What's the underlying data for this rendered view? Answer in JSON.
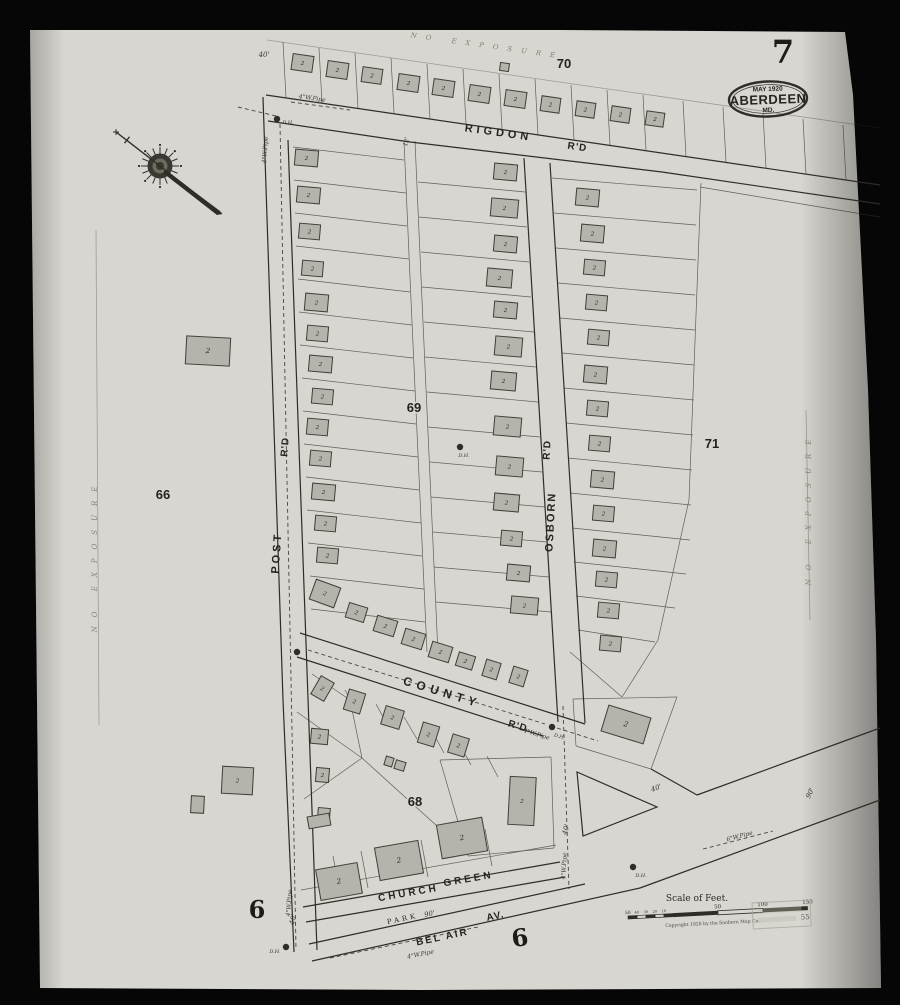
{
  "sheet": {
    "number": "7",
    "badge": {
      "line1": "MAY 1920",
      "city": "ABERDEEN",
      "state": "MD."
    }
  },
  "legend": {
    "scale_title": "Scale of Feet.",
    "copyright": "Copyright 1920 by the Sanborn Map Co.",
    "bar_ticks_small": [
      "50",
      "40",
      "30",
      "20",
      "10"
    ],
    "bar_ticks_big": [
      "50",
      "100",
      "150"
    ],
    "stamp_text": "55"
  },
  "colors": {
    "bg": "#060606",
    "paper": "#d8d6d0",
    "ink": "#2e2d27",
    "building_fill": "#b5b3ac",
    "building_stroke": "#403e37",
    "faint": "#8a877c"
  },
  "labels": [
    {
      "t": "RIGDON",
      "x": 498,
      "y": 136,
      "r": 8,
      "s": 11,
      "cls": "street",
      "ls": 4
    },
    {
      "t": "R'D",
      "x": 577,
      "y": 150,
      "r": 8,
      "s": 10,
      "cls": "street",
      "ls": 1
    },
    {
      "t": "POST",
      "x": 280,
      "y": 553,
      "r": -86,
      "s": 11,
      "cls": "street",
      "ls": 3
    },
    {
      "t": "R'D",
      "x": 288,
      "y": 447,
      "r": -86,
      "s": 10,
      "cls": "street",
      "ls": 1
    },
    {
      "t": "OSBORN",
      "x": 554,
      "y": 522,
      "r": -87,
      "s": 11,
      "cls": "street",
      "ls": 2
    },
    {
      "t": "R'D",
      "x": 550,
      "y": 450,
      "r": -87,
      "s": 10,
      "cls": "street",
      "ls": 1
    },
    {
      "t": "COUNTY",
      "x": 441,
      "y": 696,
      "r": 17,
      "s": 12,
      "cls": "street",
      "ls": 5
    },
    {
      "t": "R'D",
      "x": 517,
      "y": 729,
      "r": 17,
      "s": 10,
      "cls": "street",
      "ls": 1
    },
    {
      "t": "CHURCH",
      "x": 409,
      "y": 896,
      "r": -10,
      "s": 10,
      "cls": "street",
      "ls": 3
    },
    {
      "t": "GREEN",
      "x": 469,
      "y": 882,
      "r": -10,
      "s": 10,
      "cls": "street",
      "ls": 3
    },
    {
      "t": "PARK",
      "x": 403,
      "y": 921,
      "r": -12,
      "s": 7,
      "cls": "serif",
      "ls": 3
    },
    {
      "t": "BEL AIR",
      "x": 443,
      "y": 940,
      "r": -12,
      "s": 10,
      "cls": "street",
      "ls": 2
    },
    {
      "t": "AV.",
      "x": 496,
      "y": 919,
      "r": -12,
      "s": 10,
      "cls": "street",
      "ls": 1
    },
    {
      "t": "70",
      "x": 564,
      "y": 68,
      "r": 0,
      "s": 13,
      "cls": "block"
    },
    {
      "t": "69",
      "x": 414,
      "y": 412,
      "r": 0,
      "s": 13,
      "cls": "block"
    },
    {
      "t": "71",
      "x": 712,
      "y": 448,
      "r": 0,
      "s": 13,
      "cls": "block"
    },
    {
      "t": "66",
      "x": 163,
      "y": 499,
      "r": 0,
      "s": 13,
      "cls": "block"
    },
    {
      "t": "68",
      "x": 415,
      "y": 806,
      "r": 0,
      "s": 13,
      "cls": "block"
    },
    {
      "t": "6",
      "x": 257,
      "y": 918,
      "r": 0,
      "s": 24,
      "cls": "ref"
    },
    {
      "t": "6",
      "x": 521,
      "y": 946,
      "r": -8,
      "s": 24,
      "cls": "ref"
    },
    {
      "t": "7",
      "x": 783,
      "y": 63,
      "r": 0,
      "s": 32,
      "cls": "ref"
    },
    {
      "t": "NO EXPOSURE",
      "x": 487,
      "y": 48,
      "r": 8,
      "s": 7,
      "cls": "exposure",
      "ls": 9
    },
    {
      "t": "NO EXPOSURE",
      "x": 97,
      "y": 555,
      "r": -90,
      "s": 7,
      "cls": "exposure",
      "ls": 9
    },
    {
      "t": "NO EXPOSURE",
      "x": 811,
      "y": 508,
      "r": -90,
      "s": 7,
      "cls": "exposure",
      "ls": 9
    },
    {
      "t": "4\"W.Pipe",
      "x": 312,
      "y": 100,
      "r": 8,
      "s": 6,
      "cls": "tiny"
    },
    {
      "t": "4\"W.Pipe",
      "x": 267,
      "y": 150,
      "r": -86,
      "s": 6,
      "cls": "tiny"
    },
    {
      "t": "4\"W.Pipe",
      "x": 291,
      "y": 903,
      "r": -86,
      "s": 6,
      "cls": "tiny"
    },
    {
      "t": "4\"W.Pipe",
      "x": 536,
      "y": 736,
      "r": 17,
      "s": 6,
      "cls": "tiny"
    },
    {
      "t": "4\"W.Pipe",
      "x": 566,
      "y": 866,
      "r": -87,
      "s": 6,
      "cls": "tiny"
    },
    {
      "t": "4\"W.Pipe",
      "x": 421,
      "y": 956,
      "r": -12,
      "s": 6,
      "cls": "tiny"
    },
    {
      "t": "6\"W.Pipe",
      "x": 740,
      "y": 838,
      "r": -15,
      "s": 6,
      "cls": "tiny"
    },
    {
      "t": "40'",
      "x": 264,
      "y": 57,
      "r": 0,
      "s": 7,
      "cls": "tiny"
    },
    {
      "t": "40'",
      "x": 568,
      "y": 830,
      "r": -75,
      "s": 7,
      "cls": "tiny"
    },
    {
      "t": "40'",
      "x": 657,
      "y": 790,
      "r": -20,
      "s": 7,
      "cls": "tiny"
    },
    {
      "t": "40'",
      "x": 295,
      "y": 920,
      "r": -75,
      "s": 7,
      "cls": "tiny"
    },
    {
      "t": "90'",
      "x": 812,
      "y": 794,
      "r": -65,
      "s": 7,
      "cls": "tiny"
    },
    {
      "t": "90'",
      "x": 430,
      "y": 916,
      "r": -12,
      "s": 7,
      "cls": "tiny"
    },
    {
      "t": "12'",
      "x": 408,
      "y": 142,
      "r": -78,
      "s": 6,
      "cls": "tiny"
    },
    {
      "t": "D.H.",
      "x": 288,
      "y": 124,
      "r": 0,
      "s": 5,
      "cls": "tiny"
    },
    {
      "t": "D.H.",
      "x": 559,
      "y": 738,
      "r": 17,
      "s": 5,
      "cls": "tiny"
    },
    {
      "t": "D.H.",
      "x": 641,
      "y": 877,
      "r": 0,
      "s": 5,
      "cls": "tiny"
    },
    {
      "t": "D.H.",
      "x": 275,
      "y": 953,
      "r": 0,
      "s": 5,
      "cls": "tiny"
    },
    {
      "t": "D.H.",
      "x": 464,
      "y": 457,
      "r": 0,
      "s": 5,
      "cls": "tiny"
    }
  ],
  "buildings": [
    [
      292,
      55,
      21,
      16,
      8,
      "2"
    ],
    [
      327,
      62,
      21,
      16,
      8,
      "2"
    ],
    [
      362,
      68,
      20,
      15,
      8,
      "2"
    ],
    [
      398,
      75,
      21,
      16,
      8,
      "2"
    ],
    [
      433,
      80,
      21,
      16,
      8,
      "2"
    ],
    [
      469,
      86,
      21,
      16,
      8,
      "2"
    ],
    [
      505,
      91,
      21,
      16,
      8,
      "2"
    ],
    [
      541,
      97,
      19,
      15,
      8,
      "2"
    ],
    [
      576,
      102,
      19,
      15,
      8,
      "2"
    ],
    [
      611,
      107,
      19,
      15,
      8,
      "2"
    ],
    [
      646,
      112,
      18,
      14,
      8,
      "2"
    ],
    [
      500,
      63,
      9,
      8,
      8,
      ""
    ],
    [
      295,
      150,
      23,
      16,
      5,
      "2"
    ],
    [
      297,
      187,
      23,
      16,
      5,
      "2"
    ],
    [
      299,
      224,
      21,
      15,
      5,
      "2"
    ],
    [
      302,
      261,
      21,
      15,
      5,
      "2"
    ],
    [
      305,
      294,
      23,
      17,
      5,
      "2"
    ],
    [
      307,
      326,
      21,
      15,
      5,
      "2"
    ],
    [
      309,
      356,
      23,
      16,
      5,
      "2"
    ],
    [
      312,
      389,
      21,
      15,
      5,
      "2"
    ],
    [
      307,
      419,
      21,
      16,
      5,
      "2"
    ],
    [
      310,
      451,
      21,
      15,
      5,
      "2"
    ],
    [
      312,
      484,
      23,
      16,
      5,
      "2"
    ],
    [
      315,
      516,
      21,
      15,
      5,
      "2"
    ],
    [
      317,
      548,
      21,
      15,
      5,
      "2"
    ],
    [
      312,
      583,
      26,
      21,
      20,
      "2"
    ],
    [
      347,
      605,
      19,
      15,
      17,
      "2"
    ],
    [
      375,
      618,
      21,
      16,
      17,
      "2"
    ],
    [
      403,
      631,
      21,
      16,
      17,
      "2"
    ],
    [
      430,
      644,
      21,
      16,
      17,
      "2"
    ],
    [
      457,
      654,
      17,
      14,
      17,
      "2"
    ],
    [
      484,
      661,
      15,
      17,
      17,
      "2"
    ],
    [
      511,
      668,
      15,
      17,
      17,
      "2"
    ],
    [
      494,
      164,
      23,
      16,
      5,
      "2"
    ],
    [
      491,
      199,
      27,
      18,
      5,
      "2"
    ],
    [
      494,
      236,
      23,
      16,
      5,
      "2"
    ],
    [
      487,
      269,
      25,
      18,
      5,
      "2"
    ],
    [
      494,
      302,
      23,
      16,
      5,
      "2"
    ],
    [
      495,
      337,
      27,
      19,
      5,
      "2"
    ],
    [
      491,
      372,
      25,
      18,
      5,
      "2"
    ],
    [
      494,
      417,
      27,
      19,
      5,
      "2"
    ],
    [
      496,
      457,
      27,
      19,
      5,
      "2"
    ],
    [
      494,
      494,
      25,
      17,
      5,
      "2"
    ],
    [
      501,
      531,
      21,
      15,
      5,
      "2"
    ],
    [
      507,
      565,
      23,
      16,
      5,
      "2"
    ],
    [
      511,
      597,
      27,
      17,
      5,
      "2"
    ],
    [
      576,
      189,
      23,
      17,
      5,
      "2"
    ],
    [
      581,
      225,
      23,
      17,
      5,
      "2"
    ],
    [
      584,
      260,
      21,
      15,
      5,
      "2"
    ],
    [
      586,
      295,
      21,
      15,
      5,
      "2"
    ],
    [
      588,
      330,
      21,
      15,
      5,
      "2"
    ],
    [
      584,
      366,
      23,
      17,
      5,
      "2"
    ],
    [
      587,
      401,
      21,
      15,
      5,
      "2"
    ],
    [
      589,
      436,
      21,
      15,
      5,
      "2"
    ],
    [
      591,
      471,
      23,
      17,
      5,
      "2"
    ],
    [
      593,
      506,
      21,
      15,
      5,
      "2"
    ],
    [
      593,
      540,
      23,
      17,
      5,
      "2"
    ],
    [
      596,
      572,
      21,
      15,
      5,
      "2"
    ],
    [
      598,
      603,
      21,
      15,
      5,
      "2"
    ],
    [
      600,
      636,
      21,
      15,
      5,
      "2"
    ],
    [
      186,
      337,
      44,
      28,
      3,
      "2"
    ],
    [
      222,
      767,
      31,
      27,
      3,
      "2"
    ],
    [
      191,
      796,
      13,
      17,
      3,
      ""
    ],
    [
      315,
      678,
      15,
      21,
      30,
      "2"
    ],
    [
      346,
      691,
      17,
      21,
      17,
      "2"
    ],
    [
      383,
      708,
      19,
      19,
      17,
      "2"
    ],
    [
      420,
      724,
      17,
      21,
      17,
      "2"
    ],
    [
      450,
      736,
      17,
      19,
      17,
      "2"
    ],
    [
      311,
      729,
      17,
      15,
      5,
      "2"
    ],
    [
      316,
      768,
      13,
      14,
      5,
      "2"
    ],
    [
      385,
      757,
      8,
      9,
      17,
      ""
    ],
    [
      395,
      761,
      10,
      9,
      17,
      ""
    ],
    [
      318,
      808,
      12,
      9,
      5,
      ""
    ],
    [
      509,
      777,
      26,
      48,
      3,
      "2"
    ],
    [
      604,
      711,
      44,
      27,
      17,
      "2"
    ],
    [
      318,
      866,
      42,
      31,
      -10,
      "2"
    ],
    [
      377,
      844,
      44,
      33,
      -10,
      "2"
    ],
    [
      439,
      821,
      46,
      34,
      -10,
      "2"
    ],
    [
      308,
      815,
      22,
      12,
      -10,
      ""
    ]
  ],
  "roads": [
    [
      266,
      95,
      880,
      185
    ],
    [
      268,
      121,
      410,
      142
    ],
    [
      410,
      142,
      662,
      172
    ],
    [
      662,
      172,
      880,
      204
    ],
    [
      263,
      97,
      283,
      700
    ],
    [
      283,
      700,
      294,
      952
    ],
    [
      288,
      140,
      317,
      950
    ],
    [
      524,
      158,
      558,
      722
    ],
    [
      550,
      163,
      585,
      723
    ],
    [
      300,
      633,
      585,
      724
    ],
    [
      297,
      657,
      543,
      736
    ],
    [
      651,
      769,
      697,
      795
    ],
    [
      697,
      795,
      880,
      728
    ],
    [
      640,
      888,
      880,
      800
    ],
    [
      312,
      961,
      640,
      888
    ],
    [
      309,
      944,
      585,
      884
    ],
    [
      303,
      907,
      560,
      862
    ],
    [
      306,
      922,
      565,
      877
    ]
  ],
  "lot_lines": [
    [
      283,
      42,
      286,
      98
    ],
    [
      319,
      48,
      322,
      103
    ],
    [
      355,
      53,
      358,
      108
    ],
    [
      391,
      58,
      394,
      113
    ],
    [
      427,
      64,
      430,
      119
    ],
    [
      463,
      69,
      466,
      124
    ],
    [
      499,
      74,
      502,
      129
    ],
    [
      535,
      79,
      538,
      135
    ],
    [
      571,
      85,
      574,
      140
    ],
    [
      607,
      90,
      610,
      145
    ],
    [
      643,
      95,
      646,
      150
    ],
    [
      683,
      101,
      686,
      156
    ],
    [
      723,
      107,
      726,
      162
    ],
    [
      763,
      113,
      766,
      168
    ],
    [
      803,
      119,
      806,
      174
    ],
    [
      843,
      125,
      846,
      180
    ],
    [
      293,
      147,
      404,
      160
    ],
    [
      294,
      180,
      406,
      193
    ],
    [
      295,
      213,
      407,
      226
    ],
    [
      296,
      246,
      409,
      259
    ],
    [
      298,
      279,
      410,
      292
    ],
    [
      299,
      312,
      412,
      325
    ],
    [
      300,
      345,
      413,
      358
    ],
    [
      302,
      378,
      415,
      391
    ],
    [
      303,
      411,
      416,
      424
    ],
    [
      304,
      444,
      418,
      457
    ],
    [
      306,
      477,
      419,
      490
    ],
    [
      307,
      510,
      421,
      523
    ],
    [
      308,
      543,
      422,
      556
    ],
    [
      310,
      576,
      424,
      589
    ],
    [
      311,
      609,
      425,
      622
    ],
    [
      404,
      141,
      411,
      300
    ],
    [
      411,
      300,
      427,
      652
    ],
    [
      415,
      141,
      422,
      300
    ],
    [
      422,
      300,
      438,
      654
    ],
    [
      418,
      182,
      525,
      192
    ],
    [
      419,
      217,
      527,
      227
    ],
    [
      421,
      252,
      529,
      262
    ],
    [
      422,
      287,
      531,
      297
    ],
    [
      424,
      322,
      534,
      332
    ],
    [
      425,
      357,
      536,
      367
    ],
    [
      427,
      392,
      538,
      402
    ],
    [
      428,
      427,
      540,
      437
    ],
    [
      430,
      462,
      542,
      472
    ],
    [
      431,
      497,
      545,
      507
    ],
    [
      433,
      532,
      547,
      542
    ],
    [
      434,
      567,
      549,
      577
    ],
    [
      436,
      602,
      551,
      612
    ],
    [
      552,
      178,
      697,
      190
    ],
    [
      554,
      213,
      696,
      225
    ],
    [
      556,
      248,
      696,
      260
    ],
    [
      558,
      283,
      695,
      295
    ],
    [
      560,
      318,
      695,
      330
    ],
    [
      562,
      353,
      694,
      365
    ],
    [
      564,
      388,
      694,
      400
    ],
    [
      566,
      423,
      693,
      435
    ],
    [
      568,
      458,
      692,
      470
    ],
    [
      570,
      493,
      691,
      505
    ],
    [
      572,
      528,
      690,
      540
    ],
    [
      574,
      562,
      686,
      574
    ],
    [
      576,
      596,
      675,
      608
    ],
    [
      578,
      630,
      655,
      642
    ],
    [
      701,
      183,
      689,
      500
    ],
    [
      689,
      500,
      658,
      640
    ],
    [
      658,
      640,
      622,
      697
    ],
    [
      570,
      652,
      622,
      697
    ],
    [
      700,
      187,
      880,
      217
    ],
    [
      573,
      699,
      677,
      697
    ],
    [
      677,
      697,
      651,
      769
    ],
    [
      651,
      769,
      576,
      746
    ],
    [
      576,
      746,
      573,
      699
    ],
    [
      440,
      760,
      551,
      757
    ],
    [
      551,
      757,
      554,
      848
    ],
    [
      554,
      848,
      468,
      856
    ],
    [
      468,
      856,
      440,
      760
    ],
    [
      301,
      890,
      556,
      845
    ],
    [
      340,
      893,
      333,
      856
    ],
    [
      368,
      888,
      361,
      851
    ],
    [
      428,
      877,
      421,
      840
    ],
    [
      492,
      866,
      485,
      829
    ],
    [
      297,
      712,
      362,
      758
    ],
    [
      362,
      758,
      304,
      799
    ],
    [
      362,
      758,
      448,
      836
    ],
    [
      350,
      700,
      362,
      758
    ],
    [
      312,
      674,
      350,
      700
    ],
    [
      345,
      690,
      356,
      710
    ],
    [
      376,
      704,
      388,
      726
    ],
    [
      404,
      717,
      417,
      739
    ],
    [
      432,
      731,
      444,
      753
    ],
    [
      459,
      743,
      471,
      765
    ],
    [
      487,
      756,
      498,
      777
    ]
  ],
  "faint_lines": [
    [
      267,
      40,
      880,
      128
    ],
    [
      96,
      230,
      99,
      725
    ],
    [
      806,
      410,
      810,
      620
    ]
  ],
  "triangle": [
    [
      577,
      772
    ],
    [
      657,
      807
    ],
    [
      583,
      836
    ]
  ],
  "dash_lines": [
    [
      [
        280,
        124
      ],
      [
        286,
        430
      ],
      [
        292,
        730
      ],
      [
        296,
        950
      ]
    ],
    [
      [
        238,
        107
      ],
      [
        276,
        116
      ]
    ],
    [
      [
        291,
        102
      ],
      [
        350,
        110
      ]
    ],
    [
      [
        308,
        650
      ],
      [
        545,
        724
      ]
    ],
    [
      [
        557,
        728
      ],
      [
        598,
        741
      ]
    ],
    [
      [
        563,
        706
      ],
      [
        569,
        889
      ]
    ],
    [
      [
        330,
        958
      ],
      [
        478,
        927
      ]
    ],
    [
      [
        703,
        849
      ],
      [
        773,
        831
      ]
    ]
  ],
  "dots": [
    [
      277,
      119
    ],
    [
      460,
      447
    ],
    [
      297,
      652
    ],
    [
      552,
      727
    ],
    [
      633,
      867
    ],
    [
      286,
      947
    ]
  ],
  "compass": {
    "cx": 160,
    "cy": 166,
    "needle": [
      116,
      132,
      222,
      214
    ]
  },
  "badge_oval": {
    "cx": 768,
    "cy": 99,
    "rx": 39,
    "ry": 17.5
  },
  "scalebar": {
    "x": 628,
    "y": 916,
    "rot": -3,
    "title_x": 697,
    "title_y": 901
  },
  "paper_poly": [
    [
      30,
      30
    ],
    [
      560,
      30
    ],
    [
      845,
      32
    ],
    [
      853,
      95
    ],
    [
      868,
      390
    ],
    [
      876,
      640
    ],
    [
      881,
      988
    ],
    [
      420,
      990
    ],
    [
      40,
      988
    ]
  ]
}
